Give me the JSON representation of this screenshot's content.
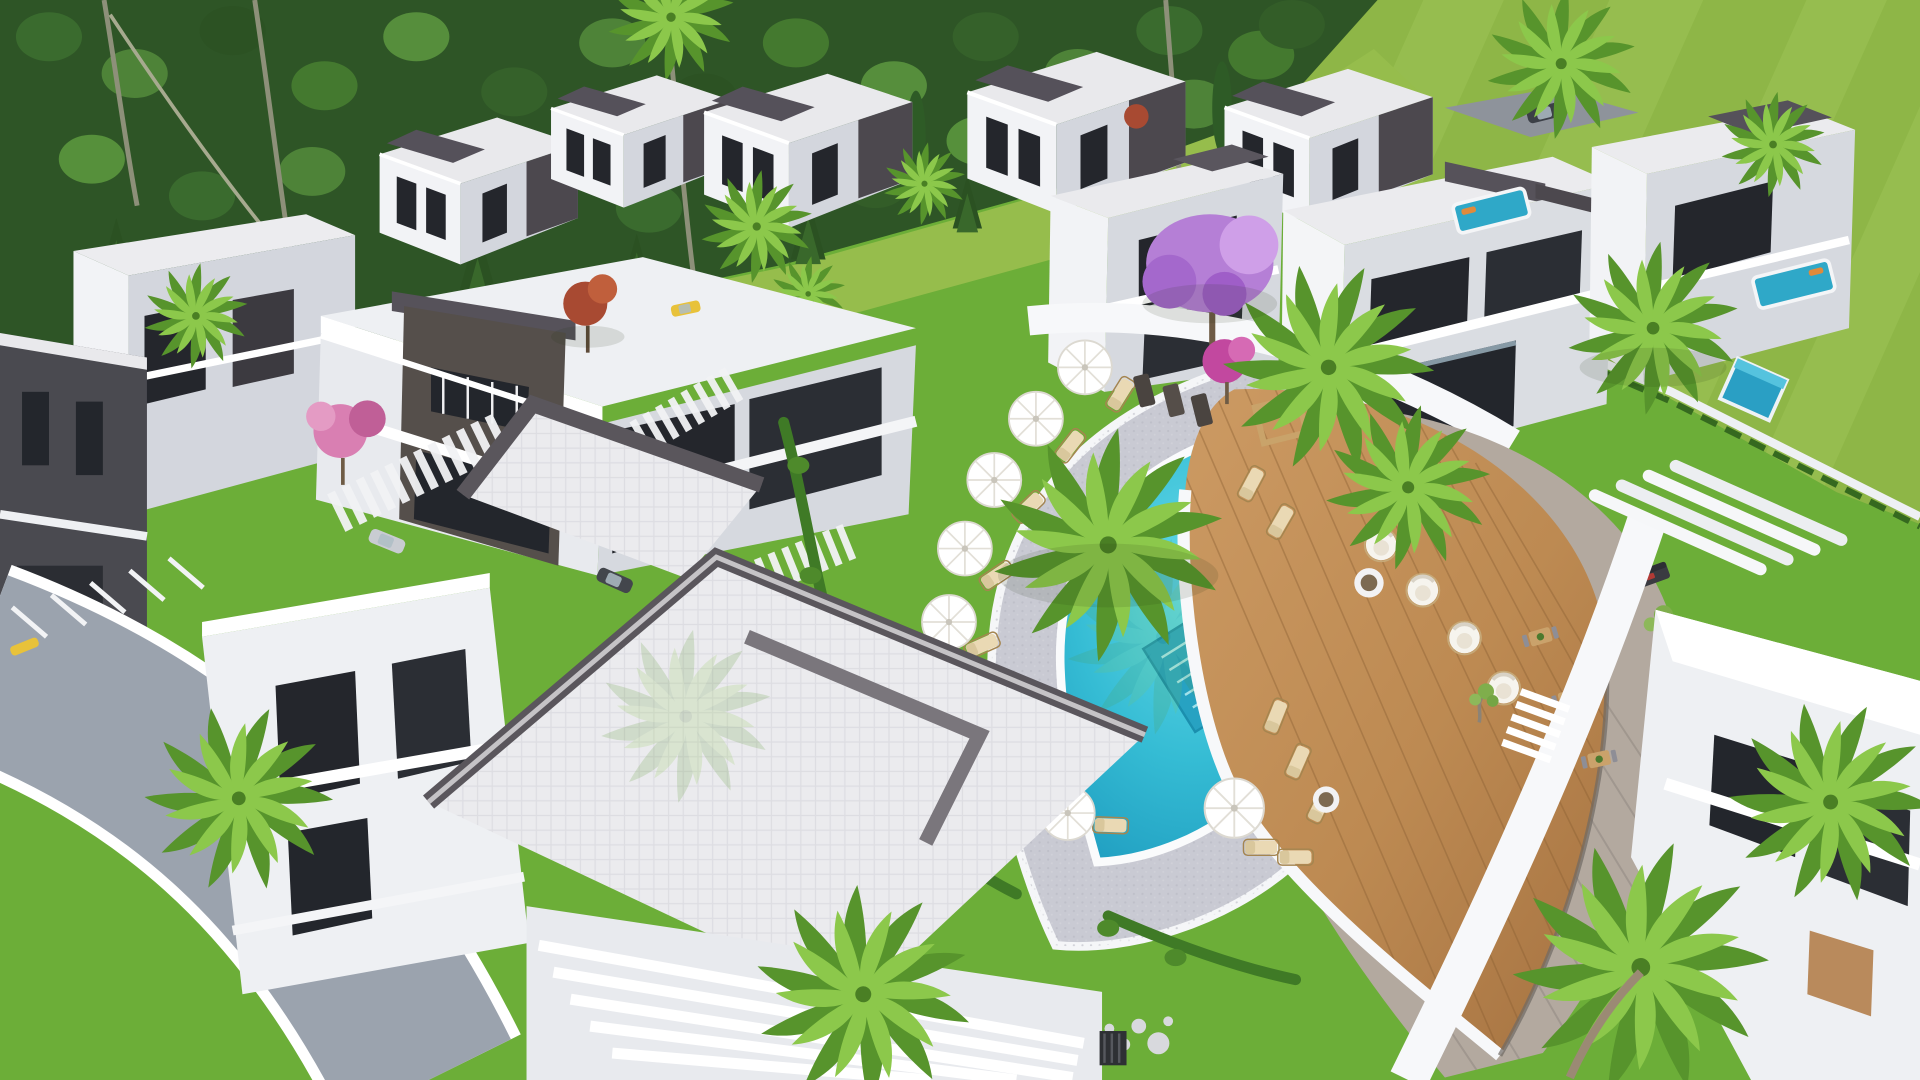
{
  "scene": {
    "type": "3d-architectural-render",
    "view": "aerial-oblique",
    "subject": "Modern luxury villa resort complex with central free-form swimming pool, leaf-shaped wooden sun deck, white curved walkways, lawns and palm trees; dense pine forest backdrop upper-left and open green field upper-right",
    "lighting": "bright midday sun from upper right"
  },
  "palette": {
    "field": "#8eb647",
    "meadow": "#96bd4c",
    "forest_dark": "#2e5526",
    "forest_mid": "#497c33",
    "forest_light": "#639a3d",
    "lawn": "#6cae38",
    "lawn_shadow": "#58942c",
    "villa_white": "#f5f5f7",
    "villa_shadow": "#ccd0d8",
    "stone_dark": "#4c484e",
    "stone_brown": "#6b6057",
    "window_dark": "#23262c",
    "roof_paver": "#eaeaec",
    "parapet": "#56525a",
    "road": "#9ba3ae",
    "path_white": "#f7f8fa",
    "pebble": "#c9cad3",
    "pool_deep": "#1f9fc0",
    "pool_main": "#3fc4da",
    "pool_steps": "#bfeef5",
    "wood_deck": "#c2905a",
    "wood_dark": "#9c6f3f",
    "plank_gray": "#b3a99f",
    "umbrella": "#ffffff",
    "lounger_cream": "#ead9b4",
    "pod_white": "#f6f4ee",
    "palm_light": "#8cc84b",
    "palm_dark": "#57942c",
    "trunk": "#9b8a74",
    "jacaranda": "#b57fd6",
    "magenta_tree": "#c2489f",
    "pink_tree": "#d97fb2",
    "red_tree": "#a84a32",
    "lavender": "#7d6fd0",
    "private_pool": "#2fa8c8",
    "car_yellow": "#e8c23a",
    "car_dark": "#3c4047",
    "car_silver": "#c9ccd2"
  },
  "inventory": {
    "villas_visible": 14,
    "central_pool": "free-form eye shape with corner entry steps and submerged platform",
    "wooden_deck": "leaf/boat shape with pointed stern, white hull rim",
    "umbrellas_white": 9,
    "sun_loungers": 22,
    "lounge_pods": 4,
    "outdoor_sofas": 4,
    "dining_tables": 3,
    "palm_trees_large": 9,
    "flowering_trees": "jacaranda purple, magenta, pink bougainvillea, red ornamental",
    "private_plunge_pools": 3,
    "cars_parked": 3,
    "paths": "white curved walkways, stepping-stone ladders, round stepping stones, curved asphalt road"
  }
}
